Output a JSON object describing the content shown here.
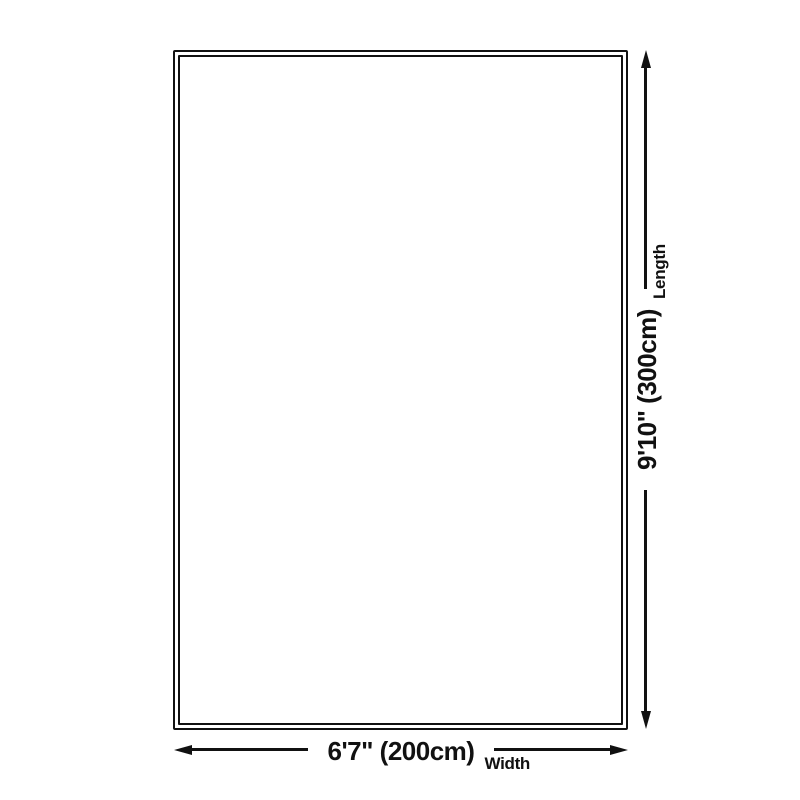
{
  "diagram": {
    "length": {
      "value": "9'10\" (300cm)",
      "label": "Length"
    },
    "width": {
      "value": "6'7\" (200cm)",
      "label": "Width"
    },
    "colors": {
      "line": "#111111",
      "text": "#111111",
      "background": "#ffffff"
    }
  }
}
